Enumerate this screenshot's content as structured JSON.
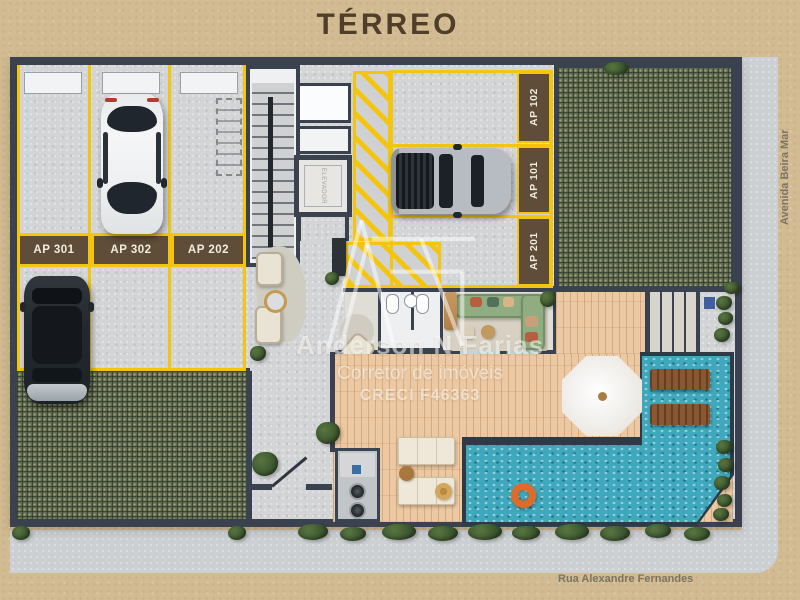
{
  "title": "TÉRREO",
  "streets": {
    "avenue": "Avenida Beira Mar",
    "street": "Rua Alexandre Fernandes"
  },
  "parking": {
    "left": [
      "AP 301",
      "AP 302",
      "AP 202"
    ],
    "right": [
      "AP 102",
      "AP 101",
      "AP 201"
    ]
  },
  "labels": {
    "elevator": "ELEVADOR"
  },
  "watermark": {
    "name": "Anderson N Farias",
    "role": "Corretor de imóveis",
    "creci": "CRECI F46363"
  },
  "colors": {
    "background": "#d2bb92",
    "wall": "#39424e",
    "marking_yellow": "#f3c50e",
    "label_box": "#5f4d39",
    "pool": "#3fa8bc",
    "deck_wood": "#ecc9a2",
    "grass_paver": "#5f6b50",
    "concrete": "#d3d4d6",
    "title_text": "#4f3e29"
  }
}
